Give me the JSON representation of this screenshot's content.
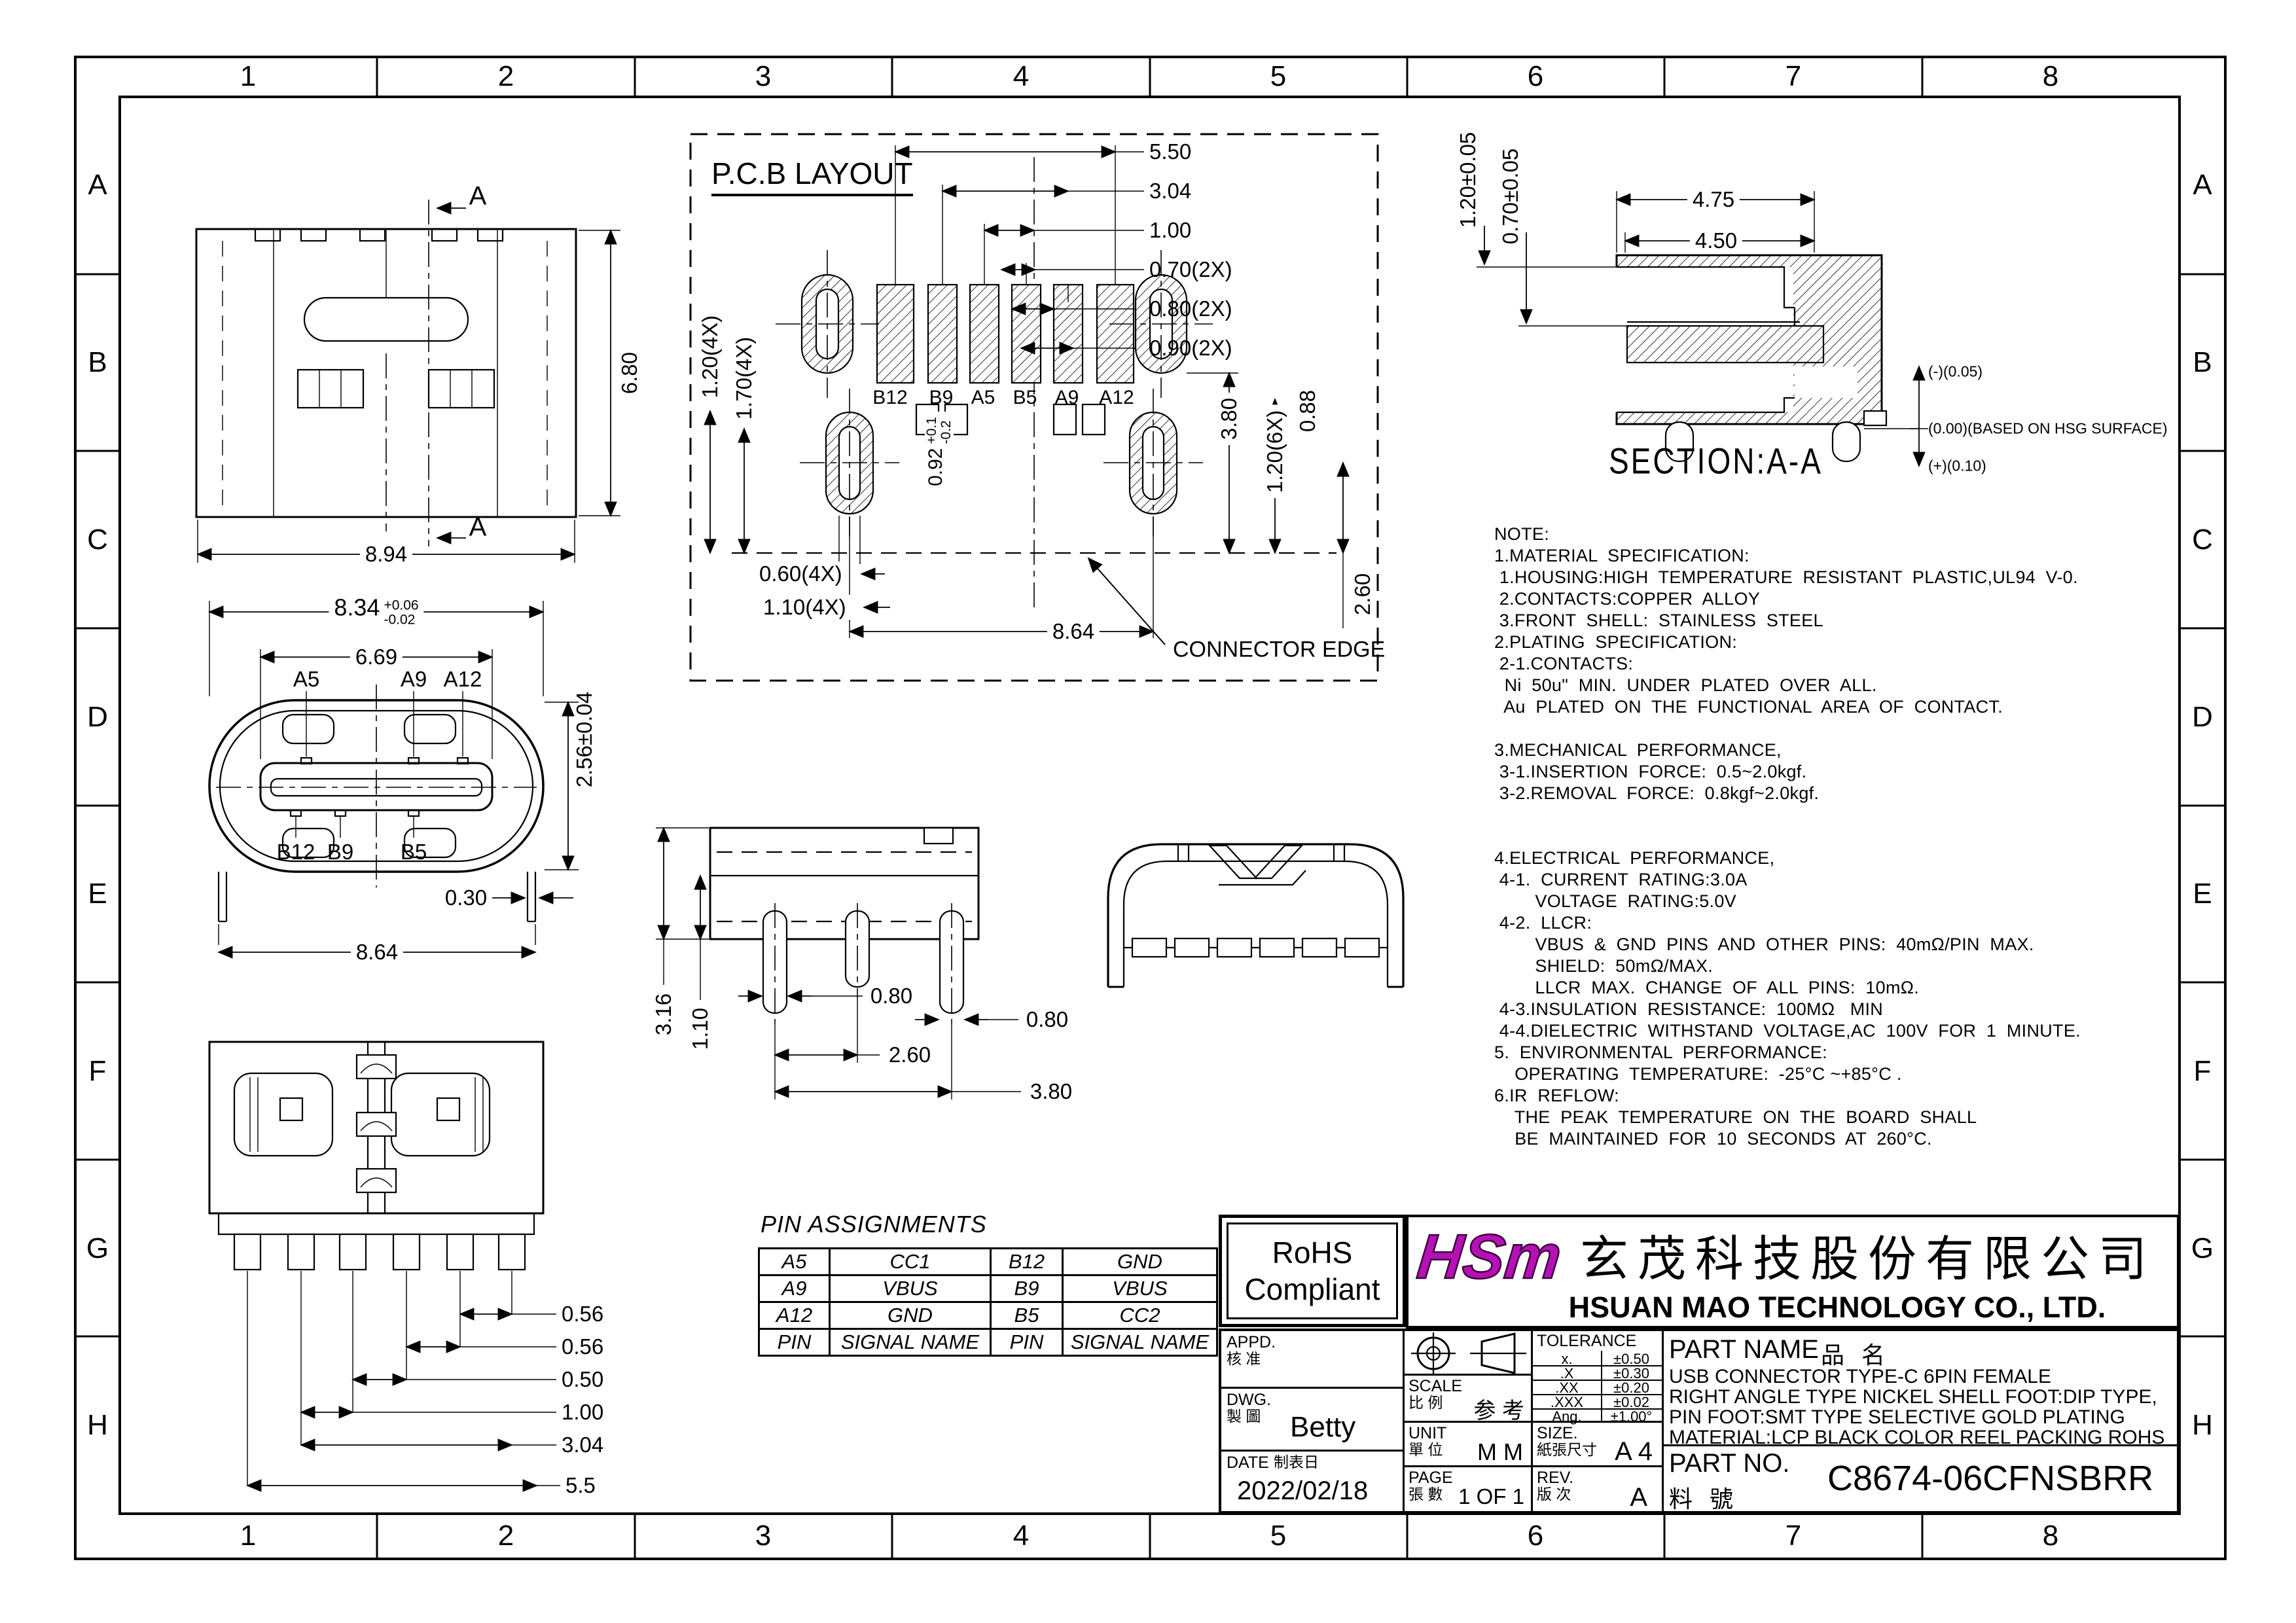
{
  "border": {
    "cols": [
      "1",
      "2",
      "3",
      "4",
      "5",
      "6",
      "7",
      "8"
    ],
    "rows": [
      "A",
      "B",
      "C",
      "D",
      "E",
      "F",
      "G",
      "H"
    ]
  },
  "top_view": {
    "section_top": "A",
    "section_bottom": "A",
    "dim_height": "6.80",
    "dim_width": "8.94"
  },
  "pcb": {
    "title": "P.C.B LAYOUT",
    "dims_top": [
      "5.50",
      "3.04",
      "1.00",
      "0.70(2X)",
      "0.80(2X)",
      "0.90(2X)"
    ],
    "pads": [
      "B12",
      "B9",
      "A5",
      "B5",
      "A9",
      "A12"
    ],
    "dim_left1": "1.20(4X)",
    "dim_left2": "1.70(4X)",
    "slot_dim": "0.92",
    "slot_plus": "+0.1",
    "slot_minus": "-0.2",
    "dim_right1": "3.80",
    "dim_right2": "1.20(6X)",
    "dim_right3": "0.88",
    "dim_b1": "0.60(4X)",
    "dim_b2": "1.10(4X)",
    "dim_b3": "8.64",
    "dim_v": "2.60",
    "edge": "CONNECTOR EDGE"
  },
  "section": {
    "dim1": "4.75",
    "dim2": "4.50",
    "dimL1": "1.20±0.05",
    "dimL2": "0.70±0.05",
    "ann1": "(-)(0.05)",
    "ann2": "(0.00)(BASED ON HSG SURFACE)",
    "ann3": "(+)(0.10)",
    "title": "SECTION:A-A"
  },
  "front": {
    "w": "8.34",
    "wp": "+0.06",
    "wm": "-0.02",
    "w2": "6.69",
    "a1": "A5",
    "a2": "A9",
    "a3": "A12",
    "h": "2.56±0.04",
    "b1": "B12",
    "b2": "B9",
    "b3": "B5",
    "leg": "0.30",
    "w3": "8.64"
  },
  "side": {
    "d1": "3.16",
    "d2": "1.10",
    "d3": "0.80",
    "d4": "0.80",
    "d5": "2.60",
    "d6": "3.80"
  },
  "bottom": {
    "dims": [
      "0.56",
      "0.56",
      "0.50",
      "1.00",
      "3.04",
      "5.5"
    ]
  },
  "notes": "NOTE:\n1.MATERIAL  SPECIFICATION:\n 1.HOUSING:HIGH  TEMPERATURE  RESISTANT  PLASTIC,UL94  V-0.\n 2.CONTACTS:COPPER  ALLOY\n 3.FRONT  SHELL:  STAINLESS  STEEL\n2.PLATING  SPECIFICATION:\n 2-1.CONTACTS:\n  Ni  50u\"  MIN.  UNDER  PLATED  OVER  ALL.\n  Au  PLATED  ON  THE  FUNCTIONAL  AREA  OF  CONTACT.\n\n3.MECHANICAL  PERFORMANCE,\n 3-1.INSERTION  FORCE:  0.5~2.0kgf.\n 3-2.REMOVAL  FORCE:  0.8kgf~2.0kgf.\n\n\n4.ELECTRICAL  PERFORMANCE,\n 4-1.  CURRENT  RATING:3.0A\n        VOLTAGE  RATING:5.0V\n 4-2.  LLCR:\n        VBUS  &  GND  PINS  AND  OTHER  PINS:  40mΩ/PIN  MAX.\n        SHIELD:  50mΩ/MAX.\n        LLCR  MAX.  CHANGE  OF  ALL  PINS:  10mΩ.\n 4-3.INSULATION  RESISTANCE:  100MΩ   MIN\n 4-4.DIELECTRIC  WITHSTAND  VOLTAGE,AC  100V  FOR  1  MINUTE.\n5.  ENVIRONMENTAL  PERFORMANCE:\n    OPERATING  TEMPERATURE:  -25°C ~+85°C .\n6.IR  REFLOW:\n    THE  PEAK  TEMPERATURE  ON  THE  BOARD  SHALL\n    BE  MAINTAINED  FOR  10  SECONDS  AT  260°C.",
  "pin_table": {
    "title": "PIN  ASSIGNMENTS",
    "rows": [
      [
        "A5",
        "CC1",
        "B12",
        "GND"
      ],
      [
        "A9",
        "VBUS",
        "B9",
        "VBUS"
      ],
      [
        "A12",
        "GND",
        "B5",
        "CC2"
      ],
      [
        "PIN",
        "SIGNAL NAME",
        "PIN",
        "SIGNAL NAME"
      ]
    ]
  },
  "rohs": {
    "l1": "RoHS",
    "l2": "Compliant"
  },
  "company": {
    "logo": "HSm",
    "zh": "玄茂科技股份有限公司",
    "en": "HSUAN MAO TECHNOLOGY CO., LTD."
  },
  "tb": {
    "appd_en": "APPD.",
    "appd_zh": "核 准",
    "dwg_en": "DWG.",
    "dwg_zh": "製 圖",
    "dwg": "Betty",
    "date_en": "DATE",
    "date_zh": "制表日",
    "date": "2022/02/18",
    "scale_en": "SCALE",
    "scale_zh": "比 例",
    "scale": "参 考",
    "unit_en": "UNIT",
    "unit_zh": "單 位",
    "unit": "M M",
    "page_en": "PAGE",
    "page_zh": "張 數",
    "page": "1 OF 1",
    "size_en": "SIZE.",
    "size_zh": "紙張尺寸",
    "size": "A 4",
    "rev_en": "REV.",
    "rev_zh": "版 次",
    "rev": "A",
    "tol_title": "TOLERANCE",
    "tol": [
      [
        "x.",
        "±0.50"
      ],
      [
        ".X",
        "±0.30"
      ],
      [
        ".XX",
        "±0.20"
      ],
      [
        ".XXX",
        "±0.02"
      ],
      [
        "Ang.",
        "±1.00°"
      ]
    ],
    "pn_en": "PART NAME",
    "pn_zh": "品   名",
    "pn_lines": [
      "USB CONNECTOR TYPE-C 6PIN FEMALE",
      "RIGHT ANGLE TYPE NICKEL SHELL FOOT:DIP TYPE,",
      "PIN FOOT:SMT TYPE SELECTIVE GOLD PLATING",
      "MATERIAL:LCP BLACK COLOR REEL PACKING ROHS"
    ],
    "pno_en": "PART NO.",
    "pno_zh": "料   號",
    "pno": "C8674-06CFNSBRR"
  }
}
